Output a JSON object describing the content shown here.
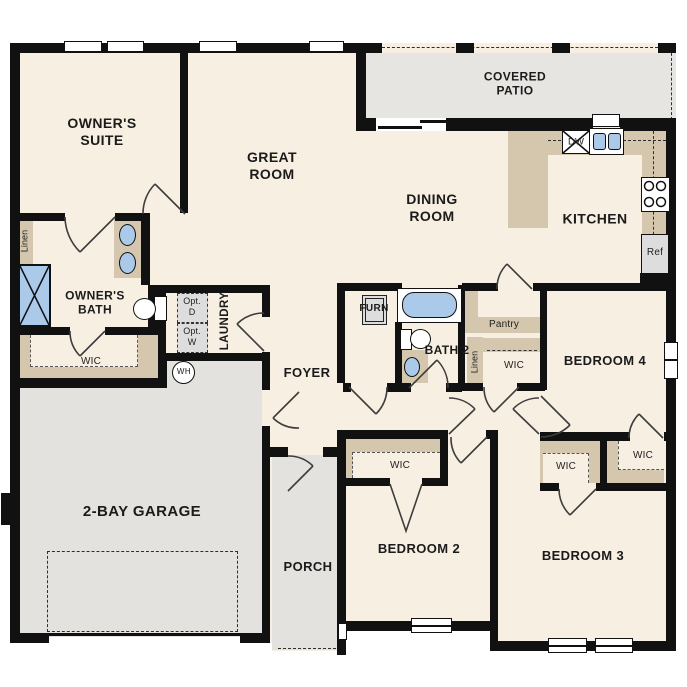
{
  "rooms": {
    "owners_suite": "OWNER'S SUITE",
    "great_room": "GREAT ROOM",
    "dining_room": "DINING ROOM",
    "kitchen": "KITCHEN",
    "covered_patio": "COVERED PATIO",
    "owners_bath": "OWNER'S BATH",
    "bath_2": "BATH 2",
    "laundry": "LAUNDRY",
    "foyer": "FOYER",
    "porch": "PORCH",
    "garage": "2-BAY GARAGE",
    "bedroom_2": "BEDROOM 2",
    "bedroom_3": "BEDROOM 3",
    "bedroom_4": "BEDROOM 4"
  },
  "closets": {
    "owner_wic": "WIC",
    "bed2_wic": "WIC",
    "bed3_wic": "WIC",
    "bed4_wic": "WIC",
    "hall_wic": "WIC",
    "pantry": "Pantry",
    "linen_owner": "Linen",
    "linen_hall": "Linen"
  },
  "fixtures": {
    "furnace": "FURN",
    "water_heater": "WH",
    "dishwasher": "DW",
    "refrigerator": "Ref",
    "optional_dryer": "Opt. D",
    "optional_washer": "Opt. W"
  },
  "colors": {
    "wall": "#111111",
    "floor": "#f7efe2",
    "garage_floor": "#e3e2df",
    "patio_floor": "#e6e5e2",
    "cabinet_tan": "#d5c7ad",
    "fixture_blue": "#abc9e9",
    "appliance_gray": "#dddddd",
    "door_stroke": "#3d3d3d"
  }
}
